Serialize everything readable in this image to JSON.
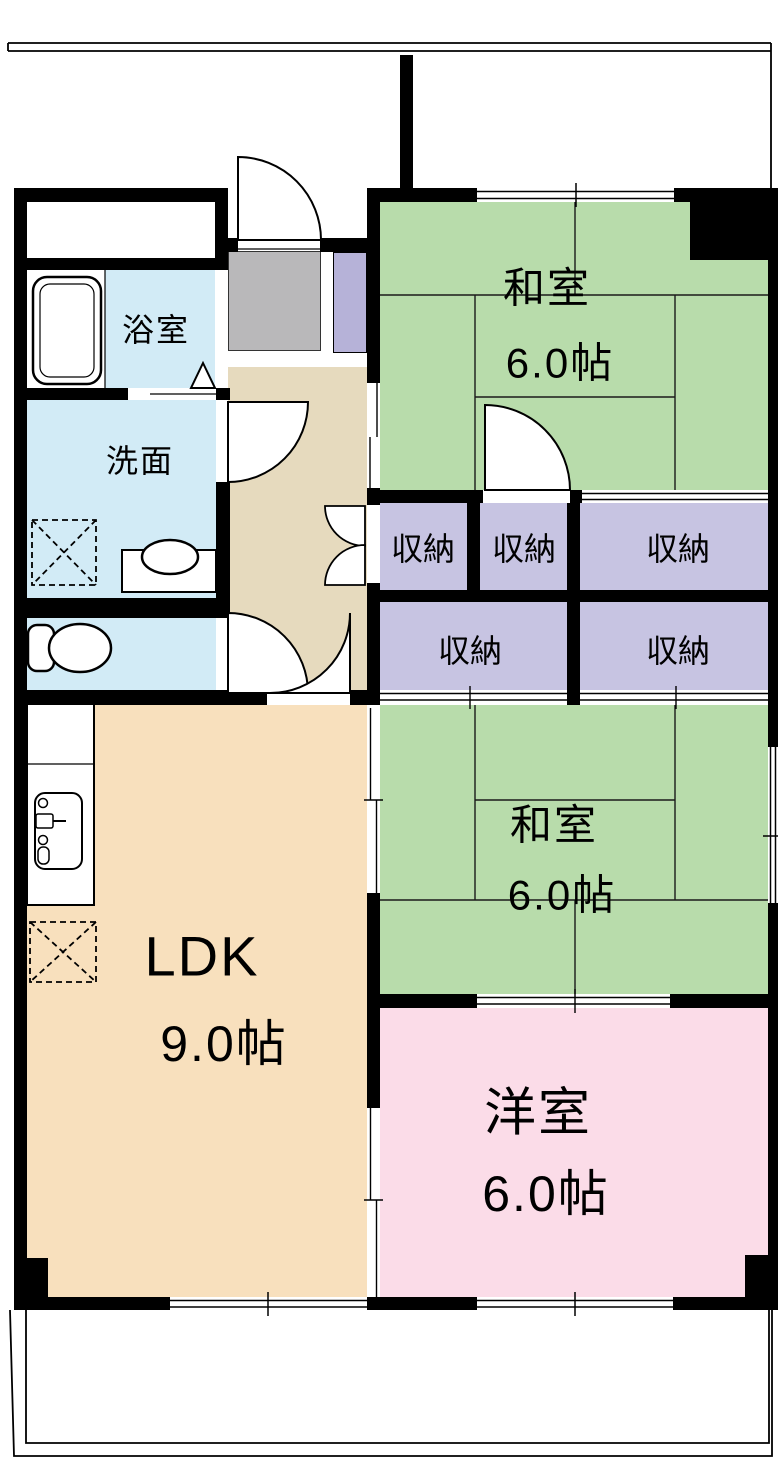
{
  "rooms": {
    "bathroom": {
      "name": "浴室"
    },
    "washroom": {
      "name": "洗面"
    },
    "japanese_room_top": {
      "name": "和室",
      "size": "6.0帖"
    },
    "japanese_room_middle": {
      "name": "和室",
      "size": "6.0帖"
    },
    "ldk": {
      "name": "LDK",
      "size": "9.0帖"
    },
    "western_room": {
      "name": "洋室",
      "size": "6.0帖"
    },
    "storages": [
      {
        "name": "収納"
      },
      {
        "name": "収納"
      },
      {
        "name": "収納"
      },
      {
        "name": "収納"
      },
      {
        "name": "収納"
      }
    ]
  },
  "colors": {
    "tatami-green": "#b8dcab",
    "storage-purple": "#c7c4e2",
    "shoe-cabinet-purple": "#b6b2d8",
    "wet-area-blue": "#d2ebf6",
    "hall-beige": "#e6dabe",
    "ldk-cream": "#f8e0bd",
    "western-pink": "#fbdce8",
    "genkan-gray": "#b9b8ba",
    "wall-black": "#000000"
  }
}
